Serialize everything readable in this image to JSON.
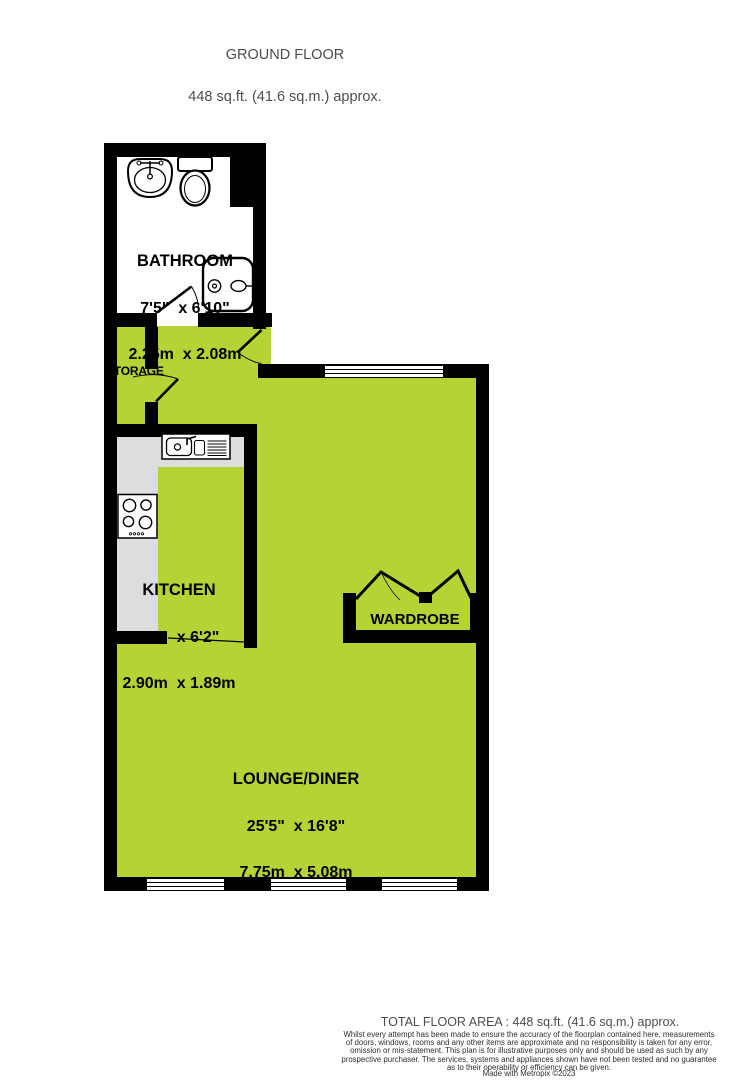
{
  "header": {
    "title": "GROUND FLOOR",
    "subtitle": "448 sq.ft. (41.6 sq.m.) approx."
  },
  "rooms": {
    "bathroom": {
      "name": "BATHROOM",
      "dims_imperial": "7'5\"  x 6'10\"",
      "dims_metric": "2.25m  x 2.08m"
    },
    "storage": {
      "name": "STORAGE"
    },
    "kitchen": {
      "name": "KITCHEN",
      "dims_imperial": "9'6\"  x 6'2\"",
      "dims_metric": "2.90m  x 1.89m"
    },
    "wardrobe": {
      "name": "WARDROBE"
    },
    "lounge_diner": {
      "name": "LOUNGE/DINER",
      "dims_imperial": "25'5\"  x 16'8\"",
      "dims_metric": "7.75m  x 5.08m"
    }
  },
  "footer": {
    "total_area": "TOTAL FLOOR AREA : 448 sq.ft. (41.6 sq.m.) approx.",
    "disclaimer": "Whilst every attempt has been made to ensure the accuracy of the floorplan contained here, measurements\nof doors, windows, rooms and any other items are approximate and no responsibility is taken for any error,\nomission or mis-statement. This plan is for illustrative purposes only and should be used as such by any\nprospective purchaser. The services, systems and appliances shown have not been tested and no guarantee\nas to their operability or efficiency can be given.",
    "credit": "Made with Metropix ©2023"
  },
  "colors": {
    "floor": "#b5d334",
    "counter": "#dcdddd",
    "wall": "#000000",
    "heading_text": "#4d4d4d"
  }
}
